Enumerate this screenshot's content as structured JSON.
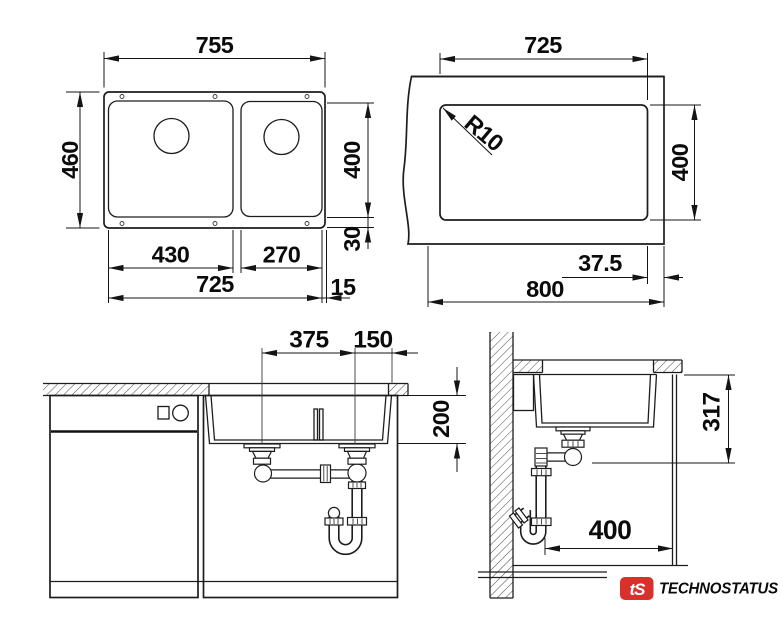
{
  "views": {
    "top": {
      "overall_width": "755",
      "overall_depth": "460",
      "main_bowl_width": "430",
      "second_bowl_width": "270",
      "bowls_total_width": "725",
      "rim_margin": "15",
      "bowl_depth": "400",
      "rear_margin": "30"
    },
    "cutout": {
      "width": "725",
      "corner_radius": "R10",
      "height": "400",
      "side_margin": "37.5",
      "total_width": "800"
    },
    "front": {
      "left_drain_offset": "375",
      "right_drain_offset": "150",
      "bowl_height": "200"
    },
    "side": {
      "drain_height": "317",
      "rear_clearance": "400"
    }
  },
  "logo": {
    "badge_text": "tS",
    "brand_name": "TECHNOSTATUS",
    "badge_color": "#d6312b",
    "brand_color": "#1e3a64"
  }
}
